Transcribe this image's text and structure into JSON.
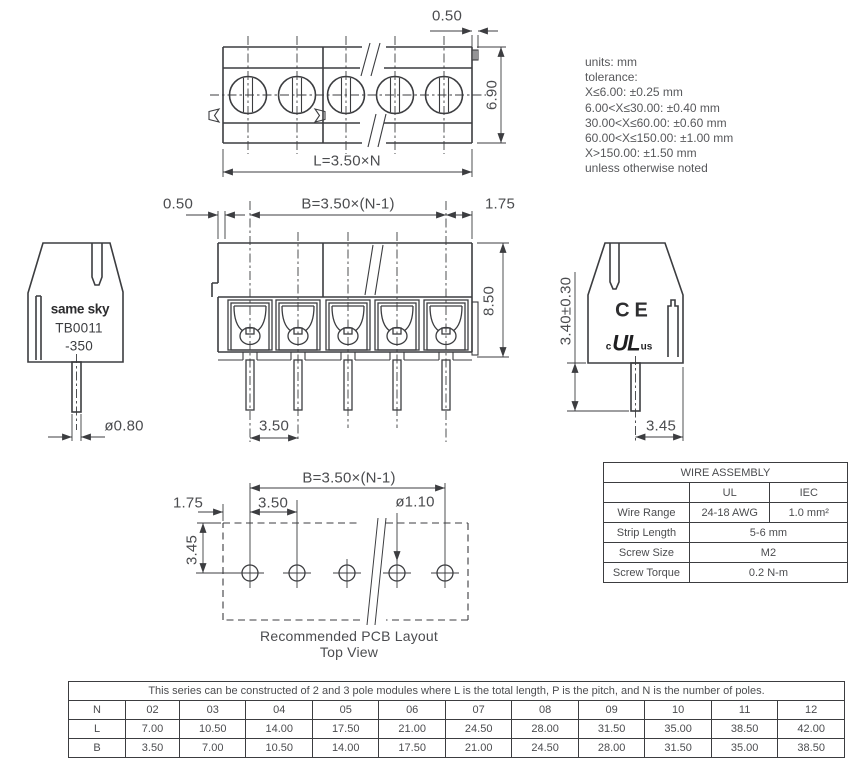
{
  "notes": {
    "lines": [
      "units: mm",
      "tolerance:",
      "X≤6.00: ±0.25 mm",
      "6.00<X≤30.00: ±0.40 mm",
      "30.00<X≤60.00: ±0.60 mm",
      "60.00<X≤150.00: ±1.00 mm",
      "X>150.00: ±1.50 mm",
      "unless otherwise noted"
    ]
  },
  "top_view": {
    "dim_tab": "0.50",
    "dim_height": "6.90",
    "dim_length": "L=3.50×N"
  },
  "front_view": {
    "dim_edge": "0.50",
    "dim_span": "B=3.50×(N-1)",
    "dim_margin": "1.75",
    "dim_height": "8.50",
    "dim_pitch": "3.50"
  },
  "left_view": {
    "brand": "same sky",
    "part_no": "TB0011",
    "part_suffix": "-350",
    "dim_pin_dia": "ø0.80"
  },
  "right_view": {
    "ce_mark": "CE",
    "ul_c": "c",
    "ul_mark": "UL",
    "ul_us": "us",
    "dim_pin_len": "3.40±0.30",
    "dim_offset": "3.45"
  },
  "pcb_layout": {
    "dim_span": "B=3.50×(N-1)",
    "dim_pitch": "3.50",
    "dim_margin": "1.75",
    "dim_hole_dia": "ø1.10",
    "dim_row_offset": "3.45",
    "caption_line1": "Recommended PCB Layout",
    "caption_line2": "Top View"
  },
  "wire_assembly": {
    "title": "WIRE ASSEMBLY",
    "col_ul": "UL",
    "col_iec": "IEC",
    "wire_range_label": "Wire Range",
    "wire_range_ul": "24-18 AWG",
    "wire_range_iec": "1.0 mm²",
    "strip_length_label": "Strip Length",
    "strip_length_value": "5-6 mm",
    "screw_size_label": "Screw Size",
    "screw_size_value": "M2",
    "screw_torque_label": "Screw Torque",
    "screw_torque_value": "0.2 N-m"
  },
  "series_table": {
    "note": "This series can be constructed of 2 and 3 pole modules where L is the total length, P is the pitch, and N is the number of poles.",
    "n_label": "N",
    "l_label": "L",
    "b_label": "B",
    "n_values": [
      "02",
      "03",
      "04",
      "05",
      "06",
      "07",
      "08",
      "09",
      "10",
      "11",
      "12"
    ],
    "l_values": [
      "7.00",
      "10.50",
      "14.00",
      "17.50",
      "21.00",
      "24.50",
      "28.00",
      "31.50",
      "35.00",
      "38.50",
      "42.00"
    ],
    "b_values": [
      "3.50",
      "7.00",
      "10.50",
      "14.00",
      "17.50",
      "21.00",
      "24.50",
      "28.00",
      "31.50",
      "35.00",
      "38.50"
    ]
  }
}
